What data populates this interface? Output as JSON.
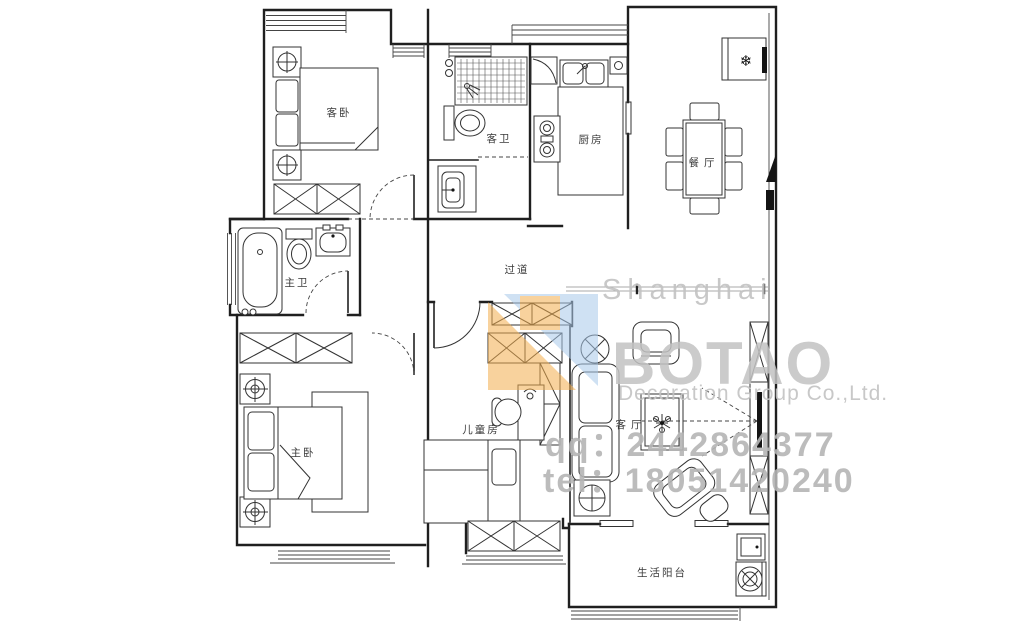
{
  "rooms": {
    "guest_bedroom": "客卧",
    "guest_bath": "客卫",
    "kitchen": "厨房",
    "dining": "餐厅",
    "master_bath": "主卫",
    "hallway": "过道",
    "master_bedroom": "主卧",
    "children_room": "儿童房",
    "living_room": "客厅",
    "balcony": "生活阳台"
  },
  "watermark": {
    "city": "Shanghai",
    "brand": "BOTAO",
    "company": "Decoration Group Co.,Ltd.",
    "qq": "qq：2442864377",
    "tel": "tel：18051420240"
  },
  "symbols": {
    "fridge": "❄"
  },
  "colors": {
    "line": "#1f1f1f",
    "watermark_gray": "#c3c3c3",
    "watermark_dark_gray": "#b5b5b5",
    "logo_orange": "#f3ae4e",
    "logo_blue": "#a9c9ea"
  }
}
